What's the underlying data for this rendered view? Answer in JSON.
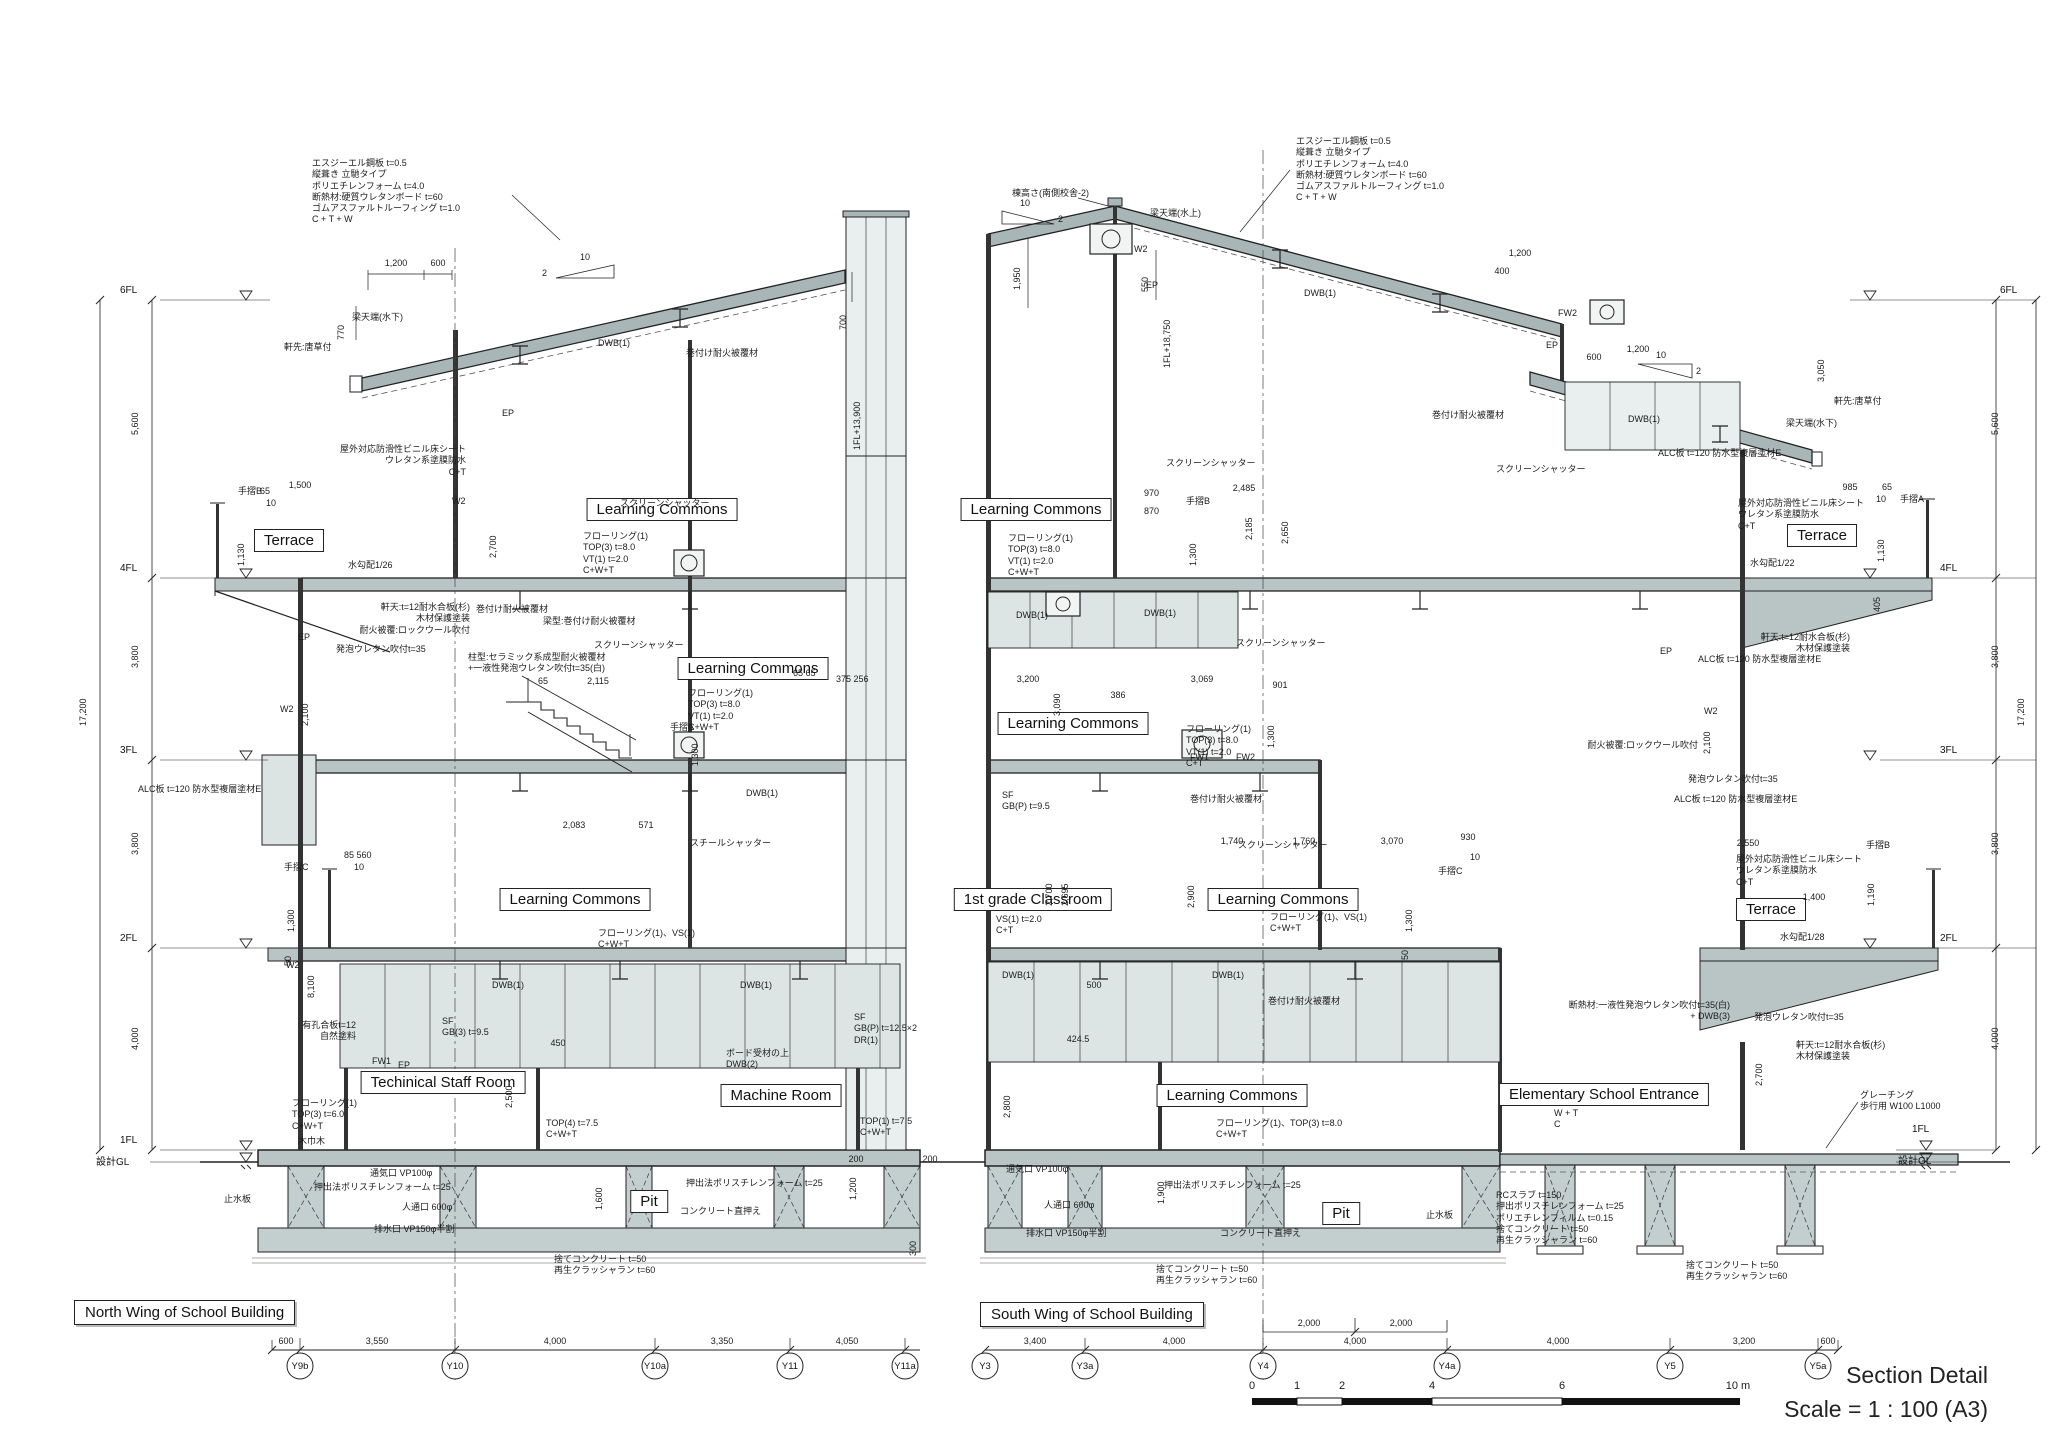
{
  "meta": {
    "sheet_title": "Section Detail",
    "sheet_scale": "Scale = 1 : 100  (A3)"
  },
  "slope": {
    "run": "10",
    "rise": "2"
  },
  "levels": {
    "l6": "6FL",
    "l4": "4FL",
    "l3": "3FL",
    "l2": "2FL",
    "l1": "1FL",
    "gl": "設計GL"
  },
  "vchain": {
    "s1": "5,600",
    "s2": "3,800",
    "s3": "3,800",
    "s4": "4,000",
    "total": "17,200"
  },
  "scalebar": {
    "t0": "0",
    "t1": "1",
    "t2": "2",
    "t4": "4",
    "t6": "6",
    "t10": "10 m"
  },
  "north": {
    "wing": "North Wing of School Building",
    "grid": {
      "g1": "Y9b",
      "g2": "Y10",
      "g3": "Y10a",
      "g4": "Y11",
      "g5": "Y11a"
    },
    "gdims": {
      "d1": "600",
      "d2": "3,550",
      "d3": "4,000",
      "d4": "3,350",
      "d5": "4,050"
    },
    "rooms": {
      "terrace": "Terrace",
      "lc4": "Learning Commons",
      "lc3": "Learning Commons",
      "lc2": "Learning Commons",
      "staff": "Techinical Staff Room",
      "machine": "Machine Room",
      "pit": "Pit"
    },
    "notes": {
      "roof_spec": "エスジーエル鋼板 t=0.5\n 縦葺き 立馳タイプ\nポリエチレンフォーム t=4.0\n断熱材:硬質ウレタンボード t=60\nゴムアスファルトルーフィング t=1.0\nC + T + W",
      "beam_low": "梁天端(水下)",
      "eave": "軒先:唐草付",
      "d770": "770",
      "d1200": "1,200",
      "d600": "600",
      "dwb_roof": "DWB(1)",
      "wrap_roof": "巻付け耐火被覆材",
      "ep1": "EP",
      "w2a": "W2",
      "d700": "700",
      "fl_top": "1FL+13,900",
      "terrace_spec": "屋外対応防滑性ビニル床シート\nウレタン系塗膜防水\nC+T",
      "rail_b": "手摺B",
      "d1500": "1,500",
      "d65": "65",
      "d10": "10",
      "d1130": "1,130",
      "slope26": "水勾配1/26",
      "soffit": "軒天:t=12耐水合板(杉)\n木材保護塗装\n耐火被覆:ロックウール吹付",
      "foam1": "発泡ウレタン吹付t=35",
      "alc1": "ALC板 t=120 防水型複層塗材E",
      "colfire": "柱型:セラミック系成型耐火被覆材\n+一液性発泡ウレタン吹付t=35(白)",
      "screen4": "スクリーンシャッター",
      "screen3": "スクリーンシャッター",
      "floor4": "フローリング(1)\nTOP(3) t=8.0\nVT(1) t=2.0\nC+W+T",
      "floor3": "フローリング(1)\nTOP(3) t=8.0\nVT(1) t=2.0\nC+W+T",
      "d2700": "2,700",
      "beamfire": "梁型:巻付け耐火被覆材",
      "wrap2": "巻付け耐火被覆材",
      "d65a": "65",
      "d2115": "2,115",
      "d6565": "65 65",
      "d375": "375 256",
      "rail_a": "手摺A",
      "d1300a": "1,300",
      "dwb3": "DWB(1)",
      "d2083": "2,083",
      "d571": "571",
      "steel": "スチールシャッター",
      "d85560": "85 560",
      "d10b": "10",
      "rail_c": "手摺C",
      "d1300b": "1,300",
      "d50": "50",
      "floor2": "フローリング(1)、VS(1)\nC+W+T",
      "dwb2a": "DWB(1)",
      "dwb2b": "DWB(1)",
      "perf": "有孔合板t=12\n自然塗料",
      "sf3": "SF\nGB(3) t=9.5",
      "d450": "450",
      "fw1": "FW1",
      "ep2": "EP",
      "d2500": "2,500",
      "board": "ボード受材の上\nDWB(2)",
      "floor1": "フローリング(1)\nTOP(3) t=6.0\nC+W+T",
      "top4": "TOP(4) t=7.5\nC+W+T",
      "kihaba": "木巾木",
      "sfp": "SF\nGB(P) t=12.5×2\nDR(1)",
      "top1": "TOP(1) t=7.5\nC+W+T",
      "extfoam1": "押出法ポリスチレンフォーム t=25",
      "vent": "通気口 VP100φ",
      "manhole": "人通口 600φ",
      "drain": "排水口 VP150φ半割",
      "shear": "止水板",
      "d1600": "1,600",
      "extfoam2": "押出法ポリスチレンフォーム t=25",
      "conc": "コンクリート直押え",
      "d1200p": "1,200",
      "d300": "300",
      "d200a": "200",
      "d200b": "200",
      "lean": "捨てコンクリート t=50\n再生クラッシャラン t=60",
      "d2100": "2,100",
      "d8100": "8,100",
      "w2b": "W2",
      "w2c": "W2",
      "ep3": "EP"
    }
  },
  "south": {
    "wing": "South Wing of School Building",
    "grid": {
      "g1": "Y3",
      "g2": "Y3a",
      "g3": "Y4",
      "g4": "Y4a",
      "g5": "Y5",
      "g6": "Y5a"
    },
    "gdims": {
      "d1": "3,400",
      "d2": "4,000",
      "d3": "4,000",
      "d4": "4,000",
      "d5": "3,200",
      "d6": "600",
      "sub1": "2,000",
      "sub2": "2,000"
    },
    "rooms": {
      "lc4": "Learning Commons",
      "lc3": "Learning Commons",
      "grade1": "1st grade Classroom",
      "lc2": "Learning Commons",
      "lc1": "Learning Commons",
      "entrance": "Elementary School Entrance",
      "pit": "Pit",
      "terrace4": "Terrace",
      "terrace2": "Terrace"
    },
    "notes": {
      "roof_spec": "エスジーエル鋼板 t=0.5\n 縦葺き 立馳タイプ\nポリエチレンフォーム t=4.0\n断熱材:硬質ウレタンボード t=60\nゴムアスファルトルーフィング t=1.0\nC + T + W",
      "ridge_h": "棟高さ(南側校舎-2)",
      "beam_top": "梁天端(水上)",
      "d1950": "1,950",
      "d550": "550",
      "w2a": "W2",
      "ep1": "EP",
      "fl_top": "1FL+18,750",
      "dwb_roof": "DWB(1)",
      "beam_low": "梁天端(水下)",
      "eave": "軒先:唐草付",
      "d1200t": "1,200",
      "d400": "400",
      "d600e": "600",
      "d1200e": "1,200",
      "d3050": "3,050",
      "fw2": "FW2",
      "ep_cl": "EP",
      "dwb_cl": "DWB(1)",
      "wrap_cl": "巻付け耐火被覆材",
      "alc_cl": "ALC板 t=120 防水型複層塗材E",
      "screen4a": "スクリーンシャッター",
      "screen4b": "スクリーンシャッター",
      "d2485": "2,485",
      "d2185": "2,185",
      "d2650": "2,650",
      "floor4": "フローリング(1)\nTOP(3) t=8.0\nVT(1) t=2.0\nC+W+T",
      "d970": "970",
      "d870": "870",
      "rail_b": "手摺B",
      "d1300a": "1,300",
      "dwb4a": "DWB(1)",
      "dwb4b": "DWB(1)",
      "screen3": "スクリーンシャッター",
      "d3200": "3,200",
      "d3090": "3,090",
      "d386": "386",
      "d3069": "3,069",
      "d901": "901",
      "floor3": "フローリング(1)\nTOP(3) t=8.0\nVT(1) t=2.0\nC+T",
      "d1300b": "1,300",
      "fw1": "FW1",
      "fw2b": "FW2",
      "sf": "SF\nGB(P) t=9.5",
      "wrap3": "巻付け耐火被覆材",
      "screen2": "スクリーンシャッター",
      "d1740": "1,740",
      "d1760": "1,760",
      "d3070": "3,070",
      "d930": "930",
      "d10": "10",
      "rail_c": "手摺C",
      "d1300c": "1,300",
      "d50": "50",
      "vs": "VS(1) t=2.0\nC+T",
      "floor2": "フローリング(1)、VS(1)\nC+W+T",
      "d2700": "2,700",
      "d2695": "2,695",
      "d2900": "2,900",
      "dwb2a": "DWB(1)",
      "dwb2b": "DWB(1)",
      "d500": "500",
      "wrap2": "巻付け耐火被覆材",
      "d424": "424.5",
      "d2800": "2,800",
      "floor1": "フローリング(1)、TOP(3) t=8.0\nC+W+T",
      "wt": "W + T\nC",
      "grating": "グレーチング\n歩行用 W100 L1000",
      "d2700r": "2,700",
      "rcslab": "RCスラブ t=150\n押出ポリスチレンフォーム t=25\nポリエチレンフィルム t=0.15\n捨てコンクリート t=50\n再生クラッシャラン t=60",
      "vent": "通気口 VP100φ",
      "manhole": "人通口 600φ",
      "extfoam": "押出法ポリスチレンフォーム t=25",
      "shear": "止水板",
      "drain": "排水口 VP150φ半割",
      "conc": "コンクリート直押え",
      "lean": "捨てコンクリート t=50\n再生クラッシャラン t=60",
      "lean_r": "捨てコンクリート t=50\n再生クラッシャラン t=60",
      "d1900": "1,900",
      "t4_spec": "屋外対応防滑性ビニル床シート\nウレタン系塗膜防水\nC+T",
      "slope22": "水勾配1/22",
      "d985": "985",
      "d65": "65",
      "d10b": "10",
      "rail_a": "手摺A",
      "d1130": "1,130",
      "d405": "405",
      "soffit4": "軒天:t=12耐水合板(杉)\n木材保護塗装",
      "alc4": "ALC板 t=120 防水型複層塗材E",
      "ep4": "EP",
      "w2b": "W2",
      "d2100": "2,100",
      "rw": "耐火被覆:ロックウール吹付",
      "foam4": "発泡ウレタン吹付t=35",
      "alc2": "ALC板 t=120 防水型複層塗材E",
      "d2550": "2,550",
      "rail_b2": "手摺B",
      "d1190": "1,190",
      "d1400": "1,400",
      "slope28": "水勾配1/28",
      "t2_spec": "屋外対応防滑性ビニル床シート\nウレタン系塗膜防水\nC+T",
      "insul": "断熱材:一液性発泡ウレタン吹付t=35(白)\n+ DWB(3)",
      "foam2b": "発泡ウレタン吹付t=35",
      "soffit2": "軒天:t=12耐水合板(杉)\n木材保護塗装"
    }
  }
}
